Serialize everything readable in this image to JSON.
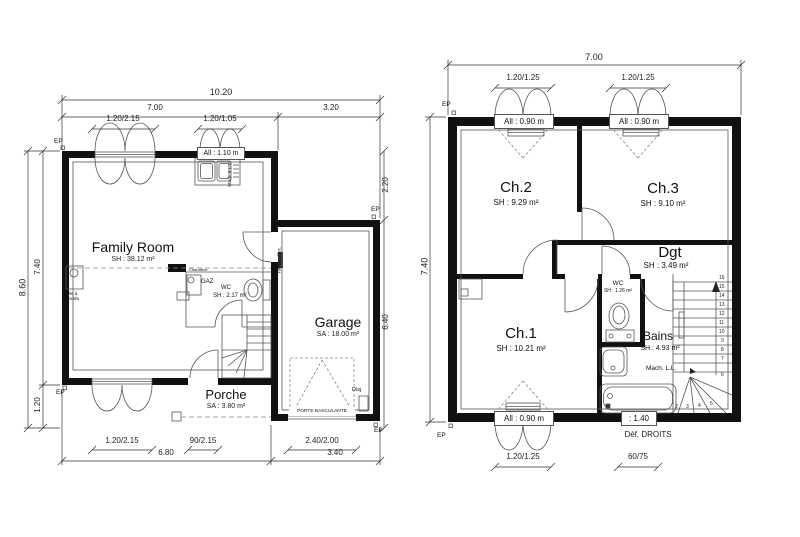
{
  "left_plan": {
    "ep": "EP",
    "dims": {
      "total_width": "10.20",
      "house_width": "7.00",
      "garage_width": "3.20",
      "door_top": "1.20/2.15",
      "window_top": "1.20/1.05",
      "kitchen_sill": "All : 1.10 m",
      "height_total": "8.60",
      "height_house": "7.40",
      "porch_height": "1.20",
      "garage_top_offset": "2.20",
      "garage_height": "6.40",
      "door_bottom": "1.20/2.15",
      "entry_door": "90/2.15",
      "garage_door": "2.40/2.00",
      "house_bottom": "6.80",
      "garage_bottom": "3.40"
    },
    "rooms": {
      "family_room": {
        "name": "Family Room",
        "area": "SH : 38.12 m²"
      },
      "wc": {
        "name": "WC",
        "area": "SH : 2.17 m²"
      },
      "garage": {
        "name": "Garage",
        "area": "SA : 18.00 m²"
      },
      "porch": {
        "name": "Porche",
        "area": "SA : 3.80 m²"
      }
    },
    "labels": {
      "boiler": "Chaudière",
      "gas": "GAZ",
      "dishwasher": "Mach. à L.V.",
      "electrical_panel": "Tableau Elec.",
      "pellet_stove": "Poêle à granulés",
      "garage_door_type": "PORTE BASCULANTE",
      "breaker": "Disj."
    }
  },
  "right_plan": {
    "ep": "EP",
    "dims": {
      "total_width": "7.00",
      "window_left": "1.20/1.25",
      "window_right": "1.20/1.25",
      "sill_left": "All : 0.90 m",
      "sill_right": "All : 0.90 m",
      "height_total": "7.40",
      "window_ch1": "1.20/1.25",
      "sill_ch1": "All : 0.90 m",
      "bath_sill": ": 1.40",
      "bath_window": "60/75",
      "def_droits": "Déf. DROITS"
    },
    "rooms": {
      "ch2": {
        "name": "Ch.2",
        "area": "SH : 9.29 m²"
      },
      "ch3": {
        "name": "Ch.3",
        "area": "SH : 9.10 m²"
      },
      "dgt": {
        "name": "Dgt",
        "area": "SH : 3.49 m²"
      },
      "ch1": {
        "name": "Ch.1",
        "area": "SH : 10.21 m²"
      },
      "wc": {
        "name": "WC",
        "area": "SH : 1.26 m²"
      },
      "bains": {
        "name": "Bains",
        "area": "SH : 4.93 m²"
      }
    },
    "labels": {
      "washing_machine": "Mach. L.L."
    },
    "stairs": {
      "numbers": [
        "16",
        "15",
        "14",
        "13",
        "12",
        "11",
        "10",
        "9",
        "8",
        "7",
        "6",
        "5",
        "4",
        "3",
        "2"
      ]
    }
  }
}
